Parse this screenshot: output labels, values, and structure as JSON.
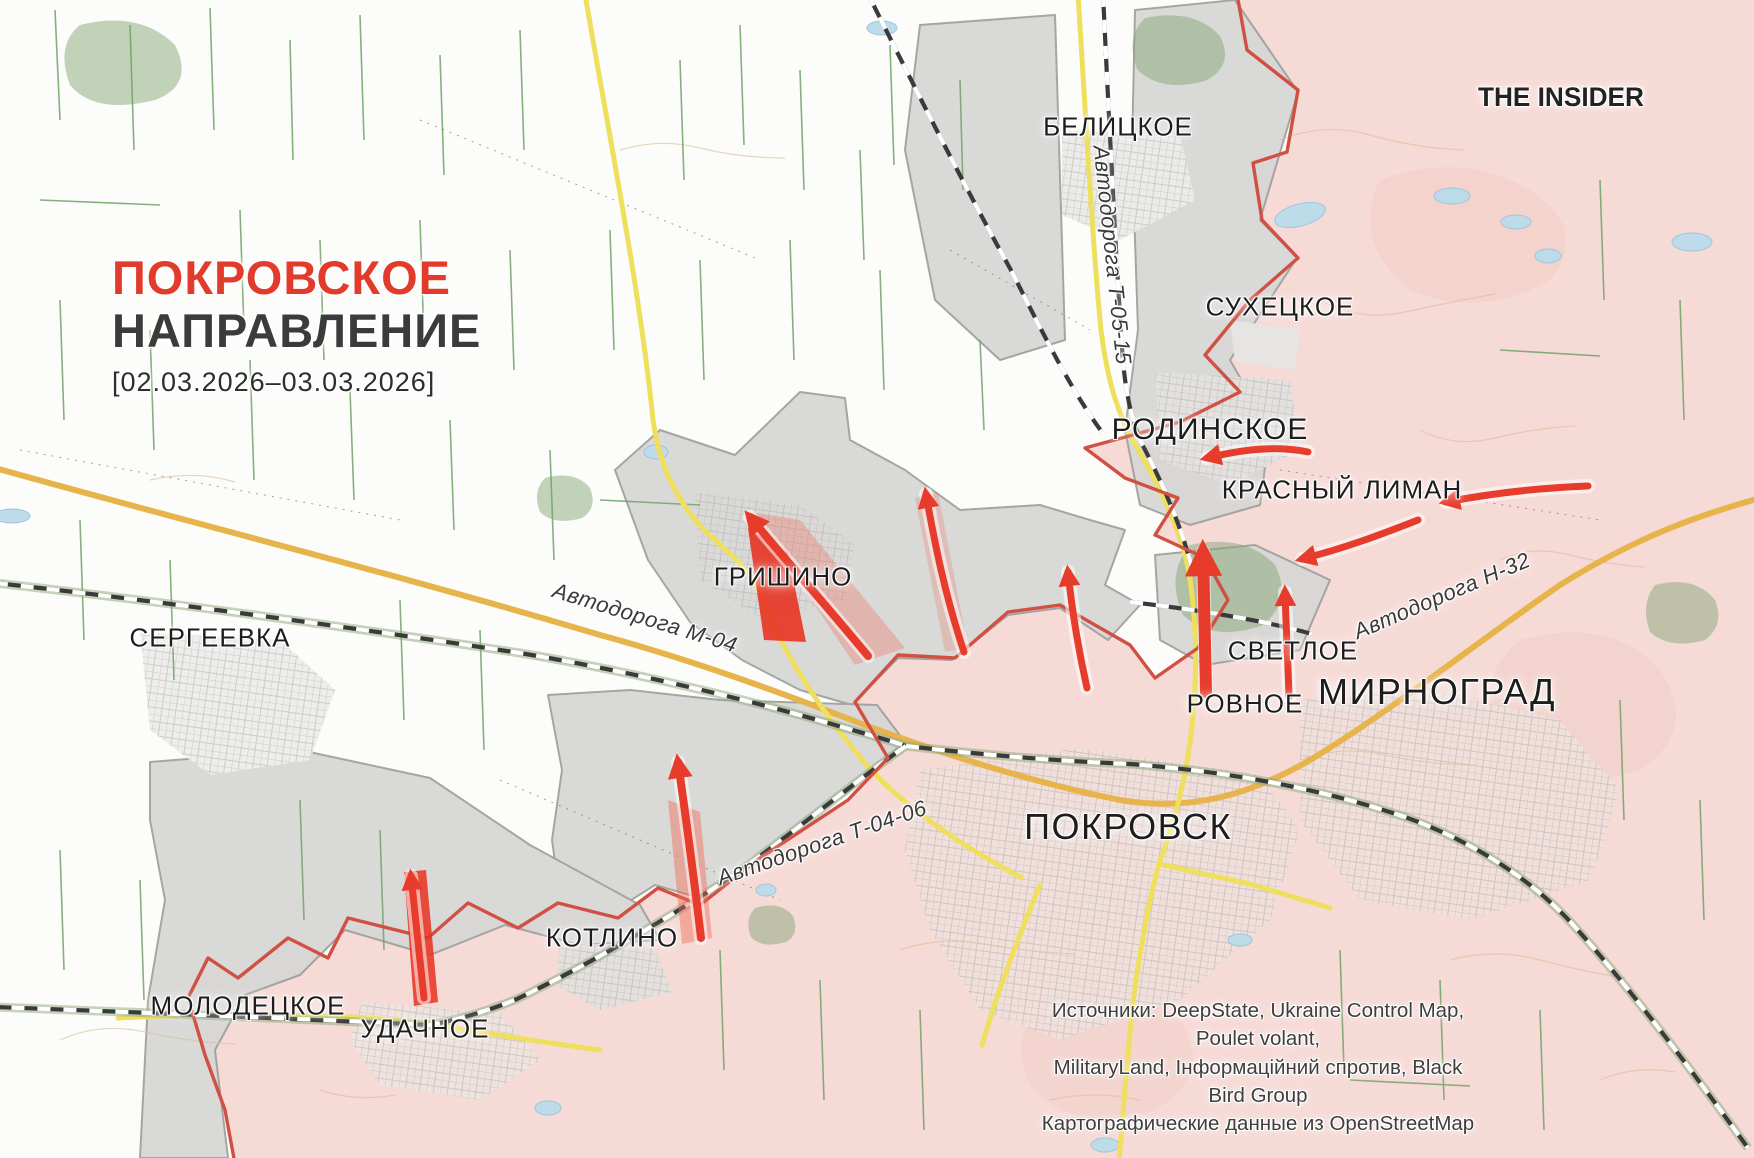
{
  "title": {
    "line1": "ПОКРОВСКОЕ",
    "line2": "НАПРАВЛЕНИЕ",
    "date_range": "[02.03.2026–03.03.2026]"
  },
  "branding": {
    "logo_text": "THE INSIDER"
  },
  "cities": [
    {
      "id": "belitskoe",
      "label": "БЕЛИЦКОЕ"
    },
    {
      "id": "sukhetskoe",
      "label": "СУХЕЦКОЕ"
    },
    {
      "id": "rodinskoe",
      "label": "РОДИНСКОЕ"
    },
    {
      "id": "krasny-liman",
      "label": "КРАСНЫЙ ЛИМАН"
    },
    {
      "id": "grishino",
      "label": "ГРИШИНО"
    },
    {
      "id": "sergeevka",
      "label": "СЕРГЕЕВКА"
    },
    {
      "id": "svetloe",
      "label": "СВЕТЛОЕ"
    },
    {
      "id": "mirnograd",
      "label": "МИРНОГРАД"
    },
    {
      "id": "rovnoe",
      "label": "РОВНОЕ"
    },
    {
      "id": "pokrovsk",
      "label": "ПОКРОВСК"
    },
    {
      "id": "kotlino",
      "label": "КОТЛИНО"
    },
    {
      "id": "molodetskoe",
      "label": "МОЛОДЕЦКОЕ"
    },
    {
      "id": "udachnoe",
      "label": "УДАЧНОЕ"
    }
  ],
  "roads": [
    {
      "id": "t-05-15",
      "label": "Автодорога Т-05-15"
    },
    {
      "id": "m-04",
      "label": "Автодорога М-04"
    },
    {
      "id": "n-32",
      "label": "Автодорога Н-32"
    },
    {
      "id": "t-04-06",
      "label": "Автодорога Т-04-06"
    }
  ],
  "sources": {
    "line1": "Источники: DeepState, Ukraine Control Map, Poulet volant,",
    "line2": "MilitaryLand, Інформаційний спротив, Black Bird Group",
    "line3": "Картографические данные из OpenStreetMap"
  },
  "colors": {
    "title_red": "#e23b2c",
    "title_dark": "#3b3b3b",
    "occupied_pink": "#f6dad6",
    "contested_gray": "#d7d7d5",
    "frontline_red": "#d15044",
    "attack_arrow_red": "#e73c2c",
    "advance_red": "#e7301f",
    "road_yellow": "#efdf5c",
    "road_orange": "#e7b44c",
    "railway_dark": "#3a3a3a",
    "field_green": "#71a268",
    "water_blue": "#bedbea"
  }
}
